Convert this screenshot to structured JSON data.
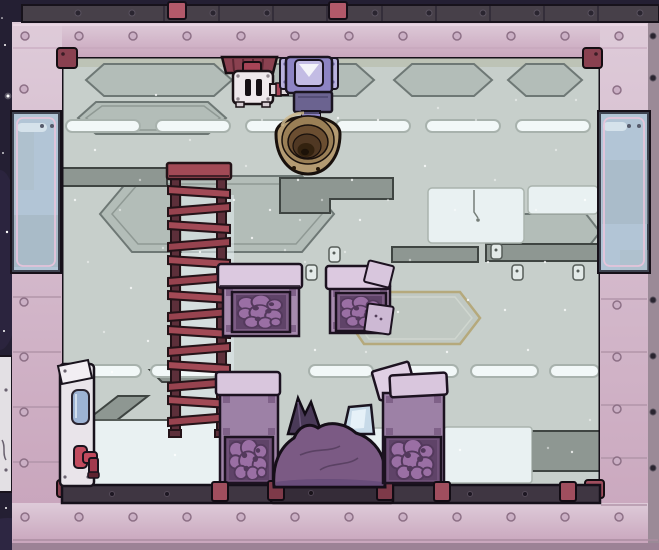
{
  "meta": {
    "app": "colony-sim game world view",
    "scene": "sealed base room: tiled walls with windows, ladder, gas pump and vent, storage bins, debris mound, water dispenser",
    "visible_text": "none"
  },
  "palette": {
    "space": "#241f33",
    "trim_dark": "#474049",
    "wall_tile_light": "#decbd9",
    "wall_tile": "#c9a6bd",
    "wall_outer": "#9b8a97",
    "bottom_outer": "#9c8296",
    "bracket_red": "#b2596a",
    "bracket_floor": "#a04e5e",
    "corner_maroon": "#8a4150",
    "interior_base": "#c7cfcb",
    "panel_white": "#e9f1f2",
    "panel_dark": "#8e9792",
    "streak_white": "#f2f8f8",
    "floor_trim": "#3f3642",
    "platform_dark": "#352c38",
    "ladder_red": "#a24a56",
    "ladder_rail": "#5d2f3a",
    "bin_lid": "#dcc9e0",
    "bin_body": "#a68aae",
    "bin_frame": "#7c5c84",
    "bin_ore": "#9a6fa4",
    "mound_purple": "#7b5a84",
    "spike_purple": "#4a3a58",
    "glass_shard": "#c7dae8",
    "horn_outer": "#b49b72",
    "pump_body": "#8d84c4",
    "pump_panel": "#c3bce4",
    "vent_white": "#efe9ec",
    "pipe_red": "#8a4150",
    "cooler_white": "#e9e4ea",
    "cooler_tank": "#9db3d4",
    "faucet_red": "#c14b5e",
    "window_glass": "#bccbd8",
    "window_outline": "#eac4dc"
  },
  "objects": {
    "gas_vent": {
      "kind": "gas vent",
      "count": 1
    },
    "gas_pump": {
      "kind": "gas pump with intake horn",
      "count": 1
    },
    "ceiling_pipe": {
      "kind": "gas pipe manifold",
      "count": 1
    },
    "ladder": {
      "kind": "ladder",
      "rungs": 14
    },
    "storage_bins": {
      "kind": "storage bin with ore contents",
      "count": 4,
      "open_lids": 2
    },
    "debris_mound": {
      "kind": "purple debris pile with crystal spike and glass shard",
      "count": 1
    },
    "water_cooler": {
      "kind": "wall water dispenser with red faucet",
      "count": 1
    },
    "windows": {
      "kind": "window tile",
      "count": 2
    },
    "room": {
      "walls": "pink insulated tiles",
      "background": "grey metal hull panels",
      "exterior": "starry space"
    }
  }
}
